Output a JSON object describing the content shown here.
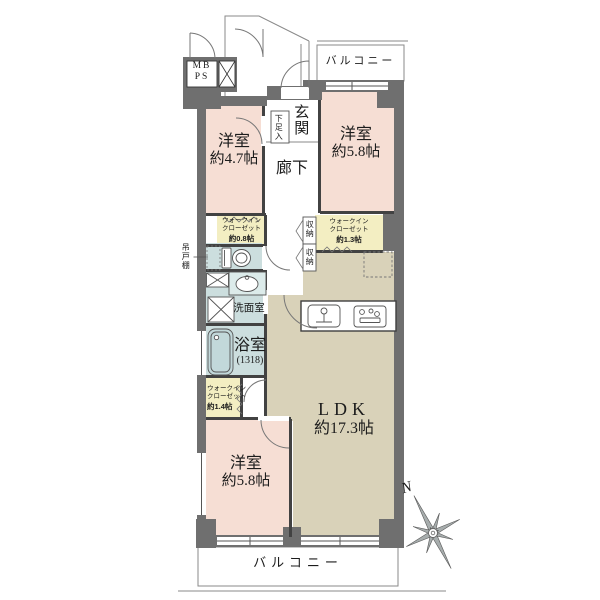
{
  "rooms": {
    "bedroom_a": {
      "name": "洋室",
      "size": "約4.7帖"
    },
    "bedroom_b": {
      "name": "洋室",
      "size": "約5.8帖"
    },
    "bedroom_c": {
      "name": "洋室",
      "size": "約5.8帖"
    },
    "ldk": {
      "name": "LDK",
      "size": "約17.3帖"
    },
    "entrance": {
      "name": "玄関"
    },
    "hallway": {
      "name": "廊下"
    },
    "washroom": {
      "name": "洗面室"
    },
    "bathroom": {
      "name": "浴室",
      "size": "(1318)"
    }
  },
  "storage": {
    "wic_entry": {
      "line1": "ウォークイン",
      "line2": "クローゼット",
      "line3": "約0.8帖"
    },
    "wic_hall": {
      "line1": "ウォークイン",
      "line2": "クローゼット",
      "line3": "約1.3帖"
    },
    "wic_bath": {
      "line1": "ウォークイン",
      "line2": "クローゼット",
      "line3": "約1.4帖"
    },
    "closet_upper": {
      "name": "収納"
    },
    "closet_lower": {
      "name": "収納"
    },
    "shoe_cabinet": {
      "name": "下足入"
    },
    "hanging_cupboard": {
      "name": "吊戸棚"
    }
  },
  "exterior": {
    "balcony_top": {
      "name": "バルコニー"
    },
    "balcony_bottom": {
      "name": "バルコニー"
    }
  },
  "services": {
    "meter_box": "MB",
    "pipe_shaft": "PS"
  },
  "compass": {
    "north": "N"
  },
  "colors": {
    "bedroom_pink": "#f6ded4",
    "closet_yellow": "#f3eec2",
    "wet_area_blue": "#ccdede",
    "ldk_tan": "#d9d2b9",
    "wall_gray": "#6f6f6f"
  }
}
